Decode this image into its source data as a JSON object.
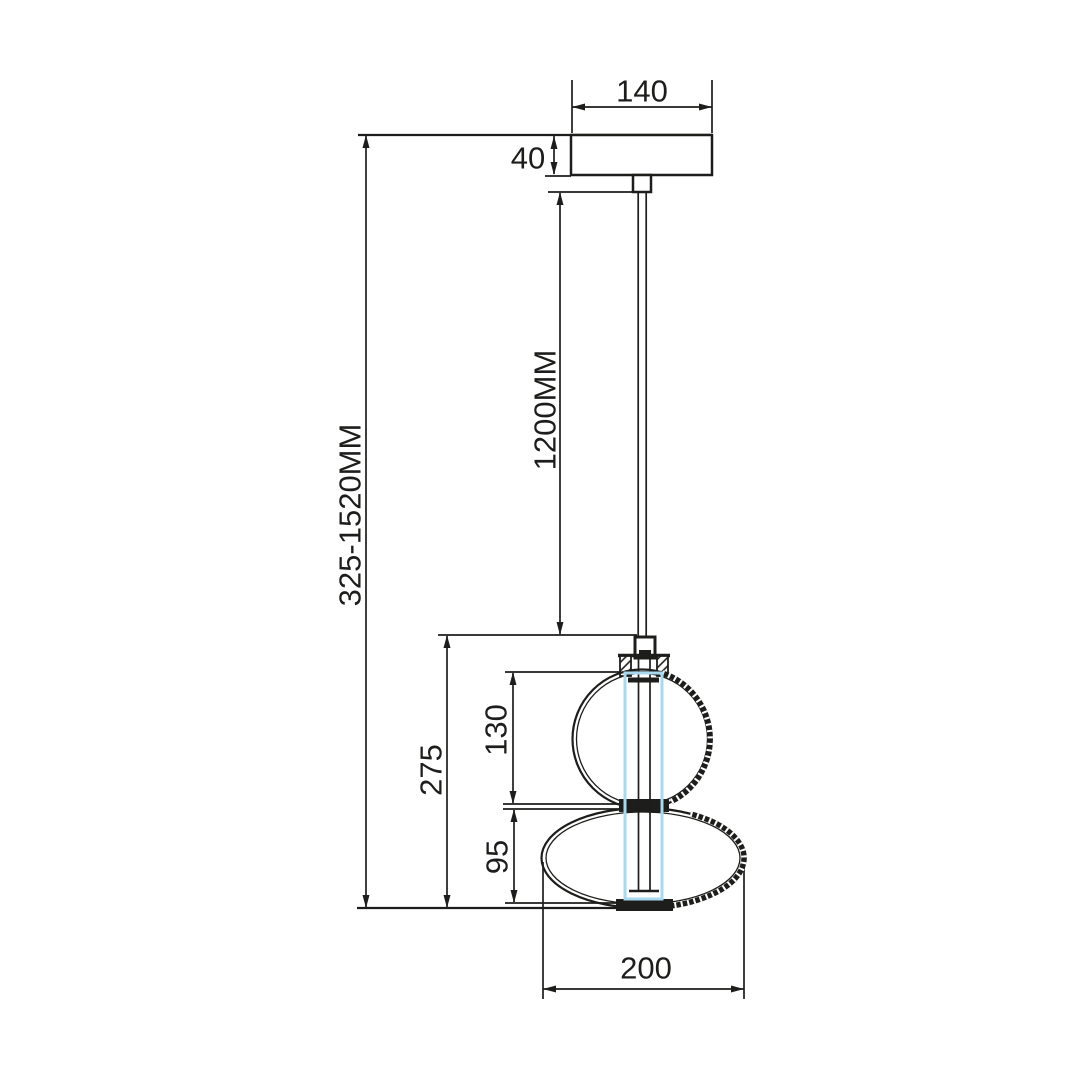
{
  "drawing": {
    "dimensions": {
      "canopy_width": "140",
      "canopy_height": "40",
      "cable_length": "1200MM",
      "overall_height": "325-1520MM",
      "body_height": "275",
      "upper_globe_height": "130",
      "lower_shade_height": "95",
      "shade_width": "200"
    },
    "colors": {
      "line": "#1d1d1b",
      "led_tube_accent": "#a9d9ef",
      "background": "#ffffff"
    }
  }
}
